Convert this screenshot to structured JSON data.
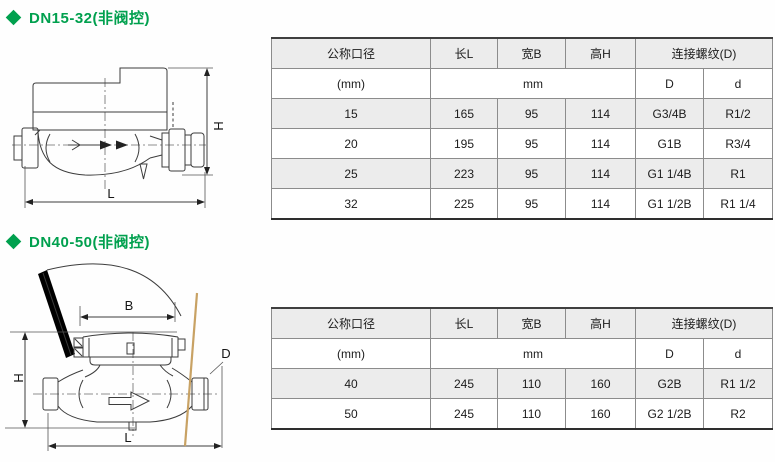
{
  "accent_color": "#00a04e",
  "tan_line_color": "#c8a264",
  "sections": [
    {
      "title": "DN15-32(非阀控)",
      "drawing": {
        "labels": {
          "H": "H",
          "L": "L"
        }
      },
      "table": {
        "col_headers": [
          "公称口径",
          "长L",
          "宽B",
          "高H",
          "连接螺纹(D)"
        ],
        "unit_row": [
          "(mm)",
          "mm",
          "D",
          "d"
        ],
        "rows": [
          [
            "15",
            "165",
            "95",
            "114",
            "G3/4B",
            "R1/2"
          ],
          [
            "20",
            "195",
            "95",
            "114",
            "G1B",
            "R3/4"
          ],
          [
            "25",
            "223",
            "95",
            "114",
            "G1 1/4B",
            "R1"
          ],
          [
            "32",
            "225",
            "95",
            "114",
            "G1 1/2B",
            "R1 1/4"
          ]
        ]
      }
    },
    {
      "title": "DN40-50(非阀控)",
      "drawing": {
        "labels": {
          "B": "B",
          "H": "H",
          "L": "L",
          "D": "D"
        }
      },
      "table": {
        "col_headers": [
          "公称口径",
          "长L",
          "宽B",
          "高H",
          "连接螺纹(D)"
        ],
        "unit_row": [
          "(mm)",
          "mm",
          "D",
          "d"
        ],
        "rows": [
          [
            "40",
            "245",
            "110",
            "160",
            "G2B",
            "R1 1/2"
          ],
          [
            "50",
            "245",
            "110",
            "160",
            "G2 1/2B",
            "R2"
          ]
        ]
      }
    }
  ]
}
